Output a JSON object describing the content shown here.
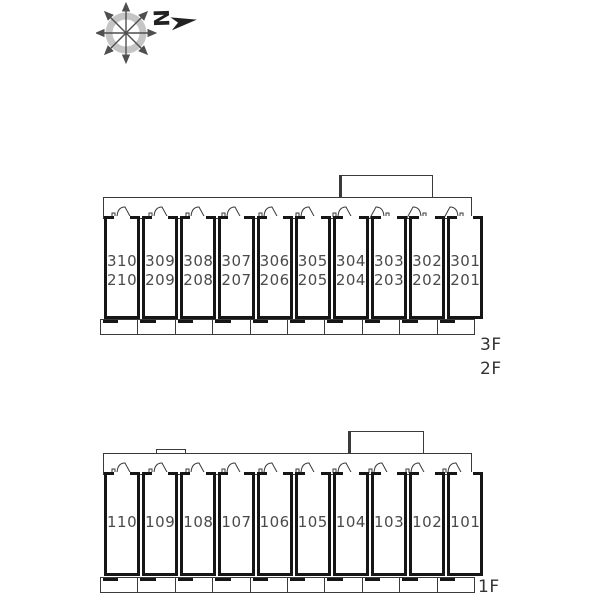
{
  "title": "apartment-unit-layout-plan",
  "colors": {
    "background": "#ffffff",
    "wall": "#161616",
    "line": "#3a3a3a",
    "room_number": "#4a4a4a",
    "floor_label": "#333333",
    "compass_ring": "#c5c5c5",
    "compass_arrows": "#4f4f4f",
    "north_mark": "#222222"
  },
  "compass": {
    "label": "N"
  },
  "upper_block": {
    "floor_labels": [
      "3F",
      "2F"
    ],
    "rooms": [
      {
        "numbers": [
          "310",
          "210"
        ]
      },
      {
        "numbers": [
          "309",
          "209"
        ]
      },
      {
        "numbers": [
          "308",
          "208"
        ]
      },
      {
        "numbers": [
          "307",
          "207"
        ]
      },
      {
        "numbers": [
          "306",
          "206"
        ]
      },
      {
        "numbers": [
          "305",
          "205"
        ]
      },
      {
        "numbers": [
          "304",
          "204"
        ]
      },
      {
        "numbers": [
          "303",
          "203"
        ]
      },
      {
        "numbers": [
          "302",
          "202"
        ]
      },
      {
        "numbers": [
          "301",
          "201"
        ]
      }
    ]
  },
  "lower_block": {
    "floor_labels": [
      "1F"
    ],
    "rooms": [
      {
        "numbers": [
          "110"
        ]
      },
      {
        "numbers": [
          "109"
        ]
      },
      {
        "numbers": [
          "108"
        ]
      },
      {
        "numbers": [
          "107"
        ]
      },
      {
        "numbers": [
          "106"
        ]
      },
      {
        "numbers": [
          "105"
        ]
      },
      {
        "numbers": [
          "104"
        ]
      },
      {
        "numbers": [
          "103"
        ]
      },
      {
        "numbers": [
          "102"
        ]
      },
      {
        "numbers": [
          "101"
        ]
      }
    ]
  }
}
